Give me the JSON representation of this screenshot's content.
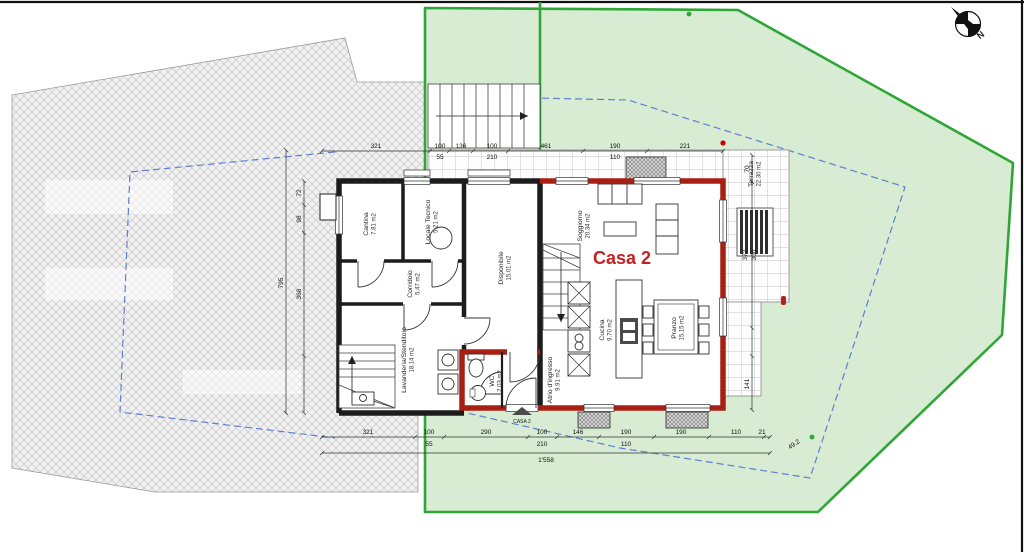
{
  "plan": {
    "building_label": "Casa 2",
    "entrance_label": "CASA 2",
    "compass_label": "N",
    "boundary_length_label": "49.2",
    "rooms": [
      {
        "name": "Cantina",
        "area": "7.81 m2"
      },
      {
        "name": "Locale Tecnico",
        "area": "5.21 m2"
      },
      {
        "name": "Corridoio",
        "area": "5.47 m2"
      },
      {
        "name": "Disponibile",
        "area": "15.01 m2"
      },
      {
        "name": "Lavanderia/Stenditoio",
        "area": "18.14 m2"
      },
      {
        "name": "Soggiorno",
        "area": "20.34 m2"
      },
      {
        "name": "Cucina",
        "area": "9.70 m2"
      },
      {
        "name": "Pranzo",
        "area": "15.15 m2"
      },
      {
        "name": "Atrio d'ingresso",
        "area": "9.91 m2"
      },
      {
        "name": "WC",
        "area": "2.03 m2"
      },
      {
        "name": "Terrazza",
        "area": "22.30 m2"
      }
    ],
    "dims": {
      "top": [
        "321",
        "100",
        "55",
        "136",
        "100",
        "210",
        "461",
        "190",
        "110",
        "221"
      ],
      "bottom": [
        "321",
        "100",
        "55",
        "290",
        "100",
        "210",
        "146",
        "190",
        "110",
        "190",
        "110",
        "21"
      ],
      "bottom_total": "1'558",
      "left": [
        "72",
        "98",
        "368",
        "795"
      ],
      "right": [
        "70",
        "372",
        "300",
        "141"
      ]
    },
    "colors": {
      "lot_border_green": "#2fa637",
      "lot_fill_green": "#d7ecd2",
      "casa2_wall_red": "#a82014",
      "accent_red": "#c42222",
      "setback_blue": "#5f7fd0",
      "wall_black": "#1c1c1c"
    }
  }
}
